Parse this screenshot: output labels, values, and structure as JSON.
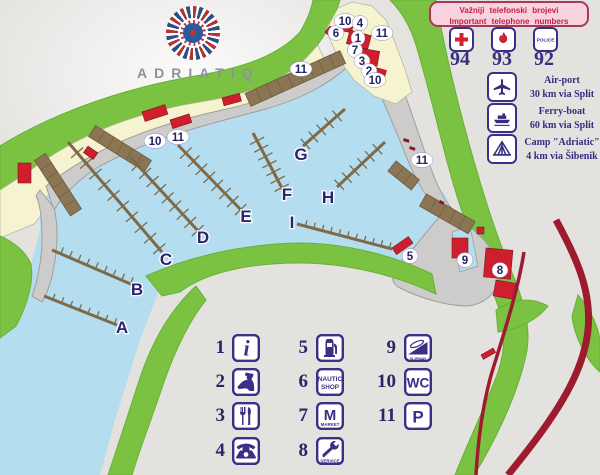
{
  "logo": {
    "brand": "ADRIATIQ"
  },
  "banner": {
    "line1": "Važniji telefonski brojevi",
    "line2": "Important telephone numbers"
  },
  "emergency": {
    "items": [
      {
        "icon": "first-aid-cross-icon",
        "number": "94"
      },
      {
        "icon": "fire-flame-icon",
        "number": "93"
      },
      {
        "icon": "police-sign-icon",
        "label": "POLICE",
        "number": "92"
      }
    ]
  },
  "info": {
    "items": [
      {
        "icon": "airplane-icon",
        "title": "Air-port",
        "subtitle": "30 km via Split"
      },
      {
        "icon": "ferry-boat-icon",
        "title": "Ferry-boat",
        "subtitle": "60 km via Split"
      },
      {
        "icon": "camp-tent-icon",
        "title": "Camp \"Adriatic\"",
        "subtitle": "4 km via Šibenik"
      }
    ]
  },
  "legend": {
    "items": [
      {
        "num": "1",
        "icon": "information-icon",
        "glyph": "i"
      },
      {
        "num": "2",
        "icon": "customs-officer-icon"
      },
      {
        "num": "3",
        "icon": "restaurant-icon"
      },
      {
        "num": "4",
        "icon": "telephone-icon"
      },
      {
        "num": "5",
        "icon": "fuel-pump-icon"
      },
      {
        "num": "6",
        "icon": "nautic-shop-icon",
        "line1": "NAUTIC",
        "line2": "SHOP"
      },
      {
        "num": "7",
        "icon": "market-icon",
        "letter": "M",
        "caption": "MARKET"
      },
      {
        "num": "8",
        "icon": "service-wrench-icon",
        "caption": "SERVICE"
      },
      {
        "num": "9",
        "icon": "slipway-icon",
        "caption": "SLIPWAY"
      },
      {
        "num": "10",
        "icon": "wc-icon",
        "text": "WC"
      },
      {
        "num": "11",
        "icon": "parking-icon",
        "text": "P"
      }
    ]
  },
  "map": {
    "pier_labels": [
      {
        "t": "A"
      },
      {
        "t": "B"
      },
      {
        "t": "C"
      },
      {
        "t": "D"
      },
      {
        "t": "E"
      },
      {
        "t": "F"
      },
      {
        "t": "G"
      },
      {
        "t": "H"
      },
      {
        "t": "I"
      }
    ],
    "markers": [
      {
        "n": "10"
      },
      {
        "n": "11"
      },
      {
        "n": "11"
      },
      {
        "n": "6"
      },
      {
        "n": "10"
      },
      {
        "n": "4"
      },
      {
        "n": "1"
      },
      {
        "n": "11"
      },
      {
        "n": "7"
      },
      {
        "n": "3"
      },
      {
        "n": "2"
      },
      {
        "n": "10"
      },
      {
        "n": "11"
      },
      {
        "n": "5"
      },
      {
        "n": "9"
      },
      {
        "n": "8"
      }
    ]
  },
  "colors": {
    "background": "#e3e2df",
    "water": "#b5ddf0",
    "land_green": "#7cc242",
    "shore_cream": "#f6f4d0",
    "quay_gray": "#cdcccb",
    "pier_brown": "#8b7553",
    "building_red": "#cf1f2f",
    "road_red": "#9e1b2f",
    "label_navy": "#29246e",
    "icon_ink": "#3b2f86",
    "banner_pink": "#f8d2de",
    "banner_text": "#c21f45"
  }
}
